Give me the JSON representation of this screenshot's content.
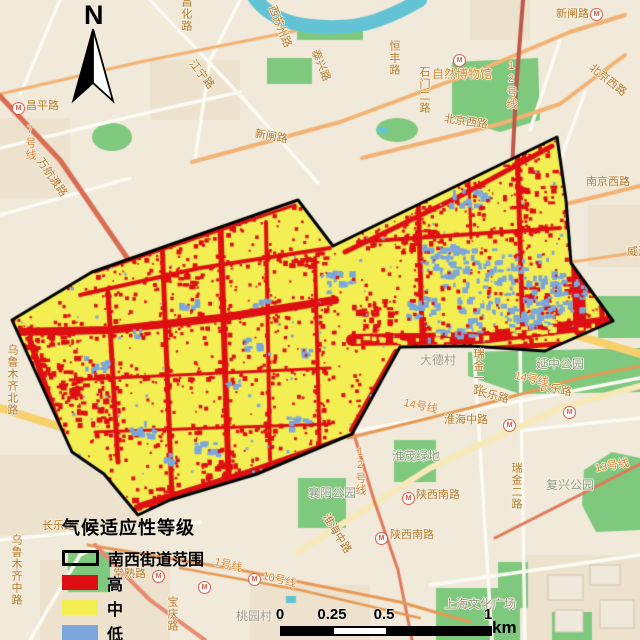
{
  "north_arrow": {
    "label": "N"
  },
  "legend": {
    "title": "气候适应性等级",
    "items": [
      {
        "label": "南西街道范围",
        "type": "outline",
        "color": "transparent"
      },
      {
        "label": "高",
        "type": "fill",
        "color": "#de0f12"
      },
      {
        "label": "中",
        "type": "fill",
        "color": "#f3ee52"
      },
      {
        "label": "低",
        "type": "fill",
        "color": "#7ba7dc"
      }
    ]
  },
  "scale_bar": {
    "ticks": [
      {
        "label": "0",
        "f": 0
      },
      {
        "label": "0.25",
        "f": 0.25
      },
      {
        "label": "0.5",
        "f": 0.5
      },
      {
        "label": "1",
        "f": 1
      }
    ],
    "unit": "km"
  },
  "colors": {
    "basemap_bg": "#f1e9da",
    "block": "#e7dcc3",
    "road_white": "#fdfbf4",
    "road_orange": "#f3b273",
    "road_salmon": "#e98a70",
    "metro_line": "#e89a54",
    "metro_red": "#e2795b",
    "rail": "#c0574a",
    "highway": "#f7d06b",
    "park": "#7ec97d",
    "water": "#62c3d5",
    "building": "#efe9db",
    "building_border": "#cfc6ae",
    "boundary": "#000000",
    "raster_high": "#de0f12",
    "raster_mid": "#f3ee52",
    "raster_low": "#7ba7dc"
  },
  "basemap": {
    "labels": [
      {
        "text": "昌平路",
        "x": 26,
        "y": 100,
        "kind": "road"
      },
      {
        "text": "昌化路",
        "x": 180,
        "y": -4,
        "kind": "road",
        "vert": true
      },
      {
        "text": "江宁路",
        "x": 196,
        "y": 58,
        "kind": "road",
        "rot": 52
      },
      {
        "text": "西苏州路",
        "x": 277,
        "y": 4,
        "kind": "road",
        "rot": 68
      },
      {
        "text": "泰兴路",
        "x": 320,
        "y": 48,
        "kind": "road",
        "rot": 68
      },
      {
        "text": "恒丰路",
        "x": 388,
        "y": 40,
        "kind": "road",
        "vert": true
      },
      {
        "text": "12号线",
        "x": 505,
        "y": 60,
        "kind": "metro",
        "vert": true
      },
      {
        "text": "石门二路",
        "x": 418,
        "y": 66,
        "kind": "road",
        "vert": true
      },
      {
        "text": "自然博物馆",
        "x": 432,
        "y": 68,
        "kind": "poi"
      },
      {
        "text": "新闸路",
        "x": 256,
        "y": 128,
        "kind": "road",
        "rot": 10
      },
      {
        "text": "新闸路",
        "x": 556,
        "y": 8,
        "kind": "road"
      },
      {
        "text": "北京西路",
        "x": 445,
        "y": 113,
        "kind": "road",
        "rot": 8
      },
      {
        "text": "北京西路",
        "x": 594,
        "y": 62,
        "kind": "road",
        "rot": 38
      },
      {
        "text": "南京西路",
        "x": 586,
        "y": 176,
        "kind": "road"
      },
      {
        "text": "威海路",
        "x": 627,
        "y": 246,
        "kind": "road"
      },
      {
        "text": "大德村",
        "x": 420,
        "y": 354,
        "kind": "vil"
      },
      {
        "text": "瑞金一路",
        "x": 472,
        "y": 348,
        "kind": "road",
        "vert": true
      },
      {
        "text": "长乐路",
        "x": 478,
        "y": 386,
        "kind": "road",
        "rot": 14
      },
      {
        "text": "长乐路",
        "x": 540,
        "y": 381,
        "kind": "road",
        "rot": 10
      },
      {
        "text": "14号线",
        "x": 405,
        "y": 397,
        "kind": "metro",
        "rot": 12
      },
      {
        "text": "14号线",
        "x": 516,
        "y": 370,
        "kind": "metro",
        "rot": 12
      },
      {
        "text": "淮海中路",
        "x": 444,
        "y": 414,
        "kind": "road"
      },
      {
        "text": "淮茂绿地",
        "x": 392,
        "y": 450,
        "kind": "park"
      },
      {
        "text": "延中公园",
        "x": 536,
        "y": 358,
        "kind": "park"
      },
      {
        "text": "襄阳公园",
        "x": 308,
        "y": 487,
        "kind": "park"
      },
      {
        "text": "陕西南路",
        "x": 416,
        "y": 489,
        "kind": "road"
      },
      {
        "text": "陕西南路",
        "x": 390,
        "y": 529,
        "kind": "road"
      },
      {
        "text": "瑞金二路",
        "x": 510,
        "y": 462,
        "kind": "road",
        "vert": true
      },
      {
        "text": "复兴公园",
        "x": 546,
        "y": 479,
        "kind": "park"
      },
      {
        "text": "13号线",
        "x": 594,
        "y": 463,
        "kind": "metro",
        "rot": -10
      },
      {
        "text": "淮海中路",
        "x": 330,
        "y": 512,
        "kind": "road",
        "rot": 58
      },
      {
        "text": "常熟路",
        "x": 113,
        "y": 568,
        "kind": "road"
      },
      {
        "text": "1号线",
        "x": 216,
        "y": 556,
        "kind": "metro",
        "rot": 14
      },
      {
        "text": "10号线",
        "x": 264,
        "y": 570,
        "kind": "metro",
        "rot": 14
      },
      {
        "text": "宝庆路",
        "x": 166,
        "y": 596,
        "kind": "road",
        "vert": true
      },
      {
        "text": "桃园村",
        "x": 236,
        "y": 610,
        "kind": "vil"
      },
      {
        "text": "上海文化广场",
        "x": 444,
        "y": 598,
        "kind": "poigray"
      },
      {
        "text": "乌鲁木齐北路",
        "x": 6,
        "y": 344,
        "kind": "road",
        "vert": true
      },
      {
        "text": "乌鲁木齐中路",
        "x": 10,
        "y": 534,
        "kind": "road",
        "vert": true
      },
      {
        "text": "长乐路",
        "x": 42,
        "y": 520,
        "kind": "road"
      },
      {
        "text": "12号线",
        "x": 354,
        "y": 446,
        "kind": "metro",
        "vert": true
      },
      {
        "text": "7号线",
        "x": 24,
        "y": 124,
        "kind": "metro",
        "vert": true
      },
      {
        "text": "万航渡路",
        "x": 44,
        "y": 156,
        "kind": "road",
        "rot": 55
      }
    ],
    "metro_icons": [
      {
        "x": 12,
        "y": 102
      },
      {
        "x": 453,
        "y": 54
      },
      {
        "x": 590,
        "y": 8
      },
      {
        "x": 503,
        "y": 419
      },
      {
        "x": 402,
        "y": 492
      },
      {
        "x": 375,
        "y": 532
      },
      {
        "x": 152,
        "y": 570
      },
      {
        "x": 198,
        "y": 581
      },
      {
        "x": 248,
        "y": 573
      },
      {
        "x": 563,
        "y": 406
      }
    ]
  }
}
